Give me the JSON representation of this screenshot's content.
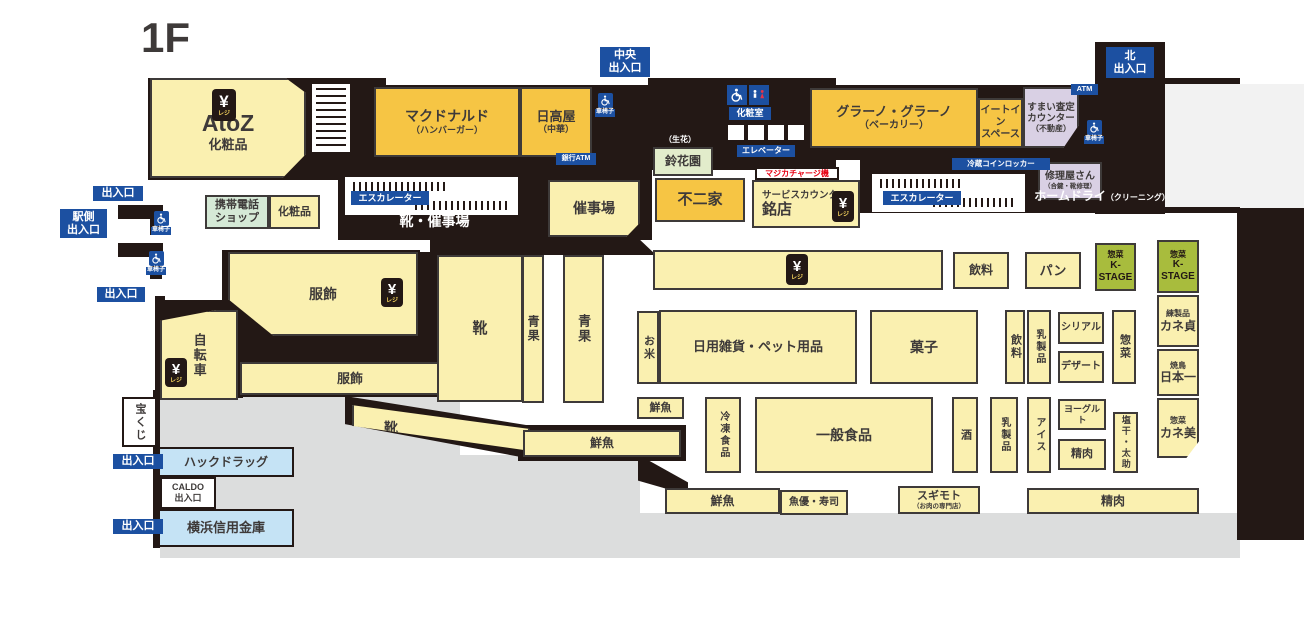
{
  "title": "1F",
  "colors": {
    "wall": "#231815",
    "cream": "#FAF0B0",
    "tenant_yellow": "#F6C544",
    "lavender": "#D9D0E4",
    "light_blue": "#C5E3F5",
    "kstage_green": "#A8BC3D",
    "label_blue": "#1C50A1",
    "exterior_gray": "#DCDDDD",
    "accent_red": "#E60012"
  },
  "icons": {
    "yen_symbol": "¥",
    "regi_label": "レジ",
    "wheelchair_label": "車椅子"
  },
  "areas": [
    {
      "id": "shop-atoz",
      "t": "AtoZ",
      "sub": "化粧品",
      "fs": 23,
      "subfs": 13,
      "cls": "cream",
      "x": 150,
      "y": 78,
      "w": 156,
      "h": 100,
      "padTop": 30,
      "clip": "polygon(0 0, 87% 0, 100% 15%, 100% 76%, 85% 100%, 0 100%)"
    },
    {
      "id": "shop-mcdonalds",
      "t": "マクドナルド",
      "sub": "（ハンバーガー）",
      "fs": 14,
      "subfs": 9,
      "cls": "tenant",
      "x": 374,
      "y": 87,
      "w": 146,
      "h": 70
    },
    {
      "id": "shop-hidakaya",
      "t": "日高屋",
      "sub": "（中華）",
      "fs": 13,
      "subfs": 9,
      "cls": "tenant",
      "x": 520,
      "y": 87,
      "w": 72,
      "h": 70
    },
    {
      "id": "shop-mobile-phone",
      "t": "携帯電話\nショップ",
      "fs": 11,
      "cls": "lgreen",
      "x": 205,
      "y": 195,
      "w": 64,
      "h": 34
    },
    {
      "id": "dept-cosmetics",
      "t": "化粧品",
      "fs": 11,
      "cls": "cream",
      "x": 269,
      "y": 195,
      "w": 51,
      "h": 34
    },
    {
      "id": "event-hall",
      "t": "催事場",
      "fs": 14,
      "cls": "cream",
      "x": 548,
      "y": 180,
      "w": 92,
      "h": 57,
      "clip": "polygon(0 0,100% 0,100% 75%,85% 100%,0 100%)"
    },
    {
      "id": "shop-fujiya",
      "t": "不二家",
      "fs": 15,
      "cls": "tenant",
      "x": 655,
      "y": 178,
      "w": 90,
      "h": 44
    },
    {
      "id": "service-counter",
      "small": "サービスカウンター",
      "smallfs": 9.5,
      "t": "銘店",
      "fs": 15,
      "cls": "cream",
      "x": 752,
      "y": 180,
      "w": 108,
      "h": 48,
      "padLeft": 8
    },
    {
      "id": "shop-grano-grano",
      "t": "グラーノ・グラーノ",
      "sub": "（ベーカリー）",
      "fs": 13,
      "subfs": 10,
      "cls": "tenant",
      "x": 810,
      "y": 88,
      "w": 168,
      "h": 60
    },
    {
      "id": "eat-in-space",
      "t": "イートイン\nスペース",
      "fs": 10,
      "cls": "tenant",
      "x": 978,
      "y": 98,
      "w": 45,
      "h": 50
    },
    {
      "id": "sumai-satei-counter",
      "t": "すまい査定\nカウンター",
      "sub": "（不動産）",
      "fs": 9.5,
      "subfs": 8,
      "cls": "lav",
      "x": 1023,
      "y": 87,
      "w": 56,
      "h": 61,
      "clip": "polygon(0 0,100% 0,100% 62%,72% 100%,0 100%)"
    },
    {
      "id": "shop-shuriyasan",
      "t": "修理屋さん",
      "sub": "（合鍵・靴修理）",
      "fs": 10,
      "subfs": 6.5,
      "cls": "lav",
      "x": 1038,
      "y": 162,
      "w": 64,
      "h": 38
    },
    {
      "id": "shop-suzukaen",
      "t": "鈴花園",
      "fs": 12,
      "cls": "sprout",
      "x": 653,
      "y": 147,
      "w": 60,
      "h": 29
    },
    {
      "id": "dept-fukushoku-upper",
      "t": "服飾",
      "fs": 14,
      "cls": "cream",
      "x": 228,
      "y": 252,
      "w": 190,
      "h": 84,
      "clip": "polygon(0 0,100% 0,100% 100%,24% 100%,0 56%)"
    },
    {
      "id": "dept-fukushoku-lower",
      "t": "服飾",
      "fs": 13,
      "cls": "cream",
      "x": 240,
      "y": 362,
      "w": 220,
      "h": 33
    },
    {
      "id": "dept-bicycle",
      "t": "自転車",
      "fs": 13,
      "v": true,
      "cls": "cream",
      "x": 160,
      "y": 310,
      "w": 78,
      "h": 90,
      "clip": "polygon(0 12%,72% 0,100% 0,100% 100%,0 100%)"
    },
    {
      "id": "dept-shoes-main",
      "t": "靴",
      "fs": 15,
      "cls": "cream",
      "x": 437,
      "y": 255,
      "w": 86,
      "h": 147
    },
    {
      "id": "dept-seika-1",
      "t": "青果",
      "fs": 12,
      "v": true,
      "cls": "cream",
      "x": 522,
      "y": 255,
      "w": 22,
      "h": 148
    },
    {
      "id": "dept-seika-2",
      "t": "青果",
      "fs": 13,
      "v": true,
      "cls": "cream",
      "x": 563,
      "y": 255,
      "w": 41,
      "h": 148
    },
    {
      "id": "dept-shoes-corridor",
      "t": "靴",
      "fs": 14,
      "cls": "cream",
      "x": 352,
      "y": 402,
      "w": 178,
      "h": 52,
      "padLeft": 30,
      "clip": "polygon(0 6%,100% 52%,100% 94%,0 46%)"
    },
    {
      "id": "dept-sengyo-strip1",
      "t": "鮮魚",
      "fs": 12,
      "cls": "cream",
      "x": 523,
      "y": 430,
      "w": 158,
      "h": 27
    },
    {
      "id": "register-row",
      "t": "",
      "fs": 12,
      "cls": "cream",
      "x": 653,
      "y": 250,
      "w": 290,
      "h": 40
    },
    {
      "id": "dept-drinks-1",
      "t": "飲料",
      "fs": 12,
      "cls": "cream",
      "x": 953,
      "y": 252,
      "w": 56,
      "h": 37
    },
    {
      "id": "dept-bread",
      "t": "パン",
      "fs": 13,
      "cls": "cream",
      "x": 1025,
      "y": 252,
      "w": 56,
      "h": 37
    },
    {
      "id": "shop-kstage-small",
      "small": "惣菜",
      "smallfs": 8,
      "t": "K-STAGE",
      "fs": 10,
      "cls": "green",
      "x": 1095,
      "y": 243,
      "w": 41,
      "h": 48
    },
    {
      "id": "shop-kstage-column",
      "small": "惣菜",
      "smallfs": 8,
      "t": "K-STAGE",
      "fs": 10,
      "cls": "green",
      "x": 1157,
      "y": 240,
      "w": 42,
      "h": 53
    },
    {
      "id": "shop-kanesada",
      "small": "練製品",
      "smallfs": 8,
      "t": "カネ貞",
      "fs": 12,
      "cls": "cream",
      "x": 1157,
      "y": 295,
      "w": 42,
      "h": 52
    },
    {
      "id": "shop-nihonichi",
      "small": "焼鳥",
      "smallfs": 8,
      "t": "日本一",
      "fs": 12,
      "cls": "cream",
      "x": 1157,
      "y": 349,
      "w": 42,
      "h": 47
    },
    {
      "id": "shop-kanemi",
      "small": "惣菜",
      "smallfs": 8,
      "t": "カネ美",
      "fs": 12,
      "cls": "cream",
      "x": 1157,
      "y": 398,
      "w": 42,
      "h": 60,
      "clip": "polygon(0 0,100% 0,100% 72%,70% 100%,0 100%)"
    },
    {
      "id": "dept-okome",
      "t": "お米",
      "fs": 11,
      "v": true,
      "cls": "cream",
      "x": 637,
      "y": 311,
      "w": 22,
      "h": 73
    },
    {
      "id": "dept-zakka-pet",
      "t": "日用雑貨・ペット用品",
      "fs": 13,
      "cls": "cream",
      "x": 659,
      "y": 310,
      "w": 198,
      "h": 74
    },
    {
      "id": "dept-kashi",
      "t": "菓子",
      "fs": 14,
      "cls": "cream",
      "x": 870,
      "y": 310,
      "w": 108,
      "h": 74
    },
    {
      "id": "dept-drinks-2",
      "t": "飲料",
      "fs": 11,
      "v": true,
      "cls": "cream",
      "x": 1005,
      "y": 310,
      "w": 20,
      "h": 74
    },
    {
      "id": "dept-dairy-1",
      "t": "乳製品",
      "fs": 10,
      "v": true,
      "cls": "cream",
      "x": 1027,
      "y": 310,
      "w": 24,
      "h": 74
    },
    {
      "id": "dept-cereal",
      "t": "シリアル",
      "fs": 10,
      "cls": "cream",
      "x": 1058,
      "y": 312,
      "w": 46,
      "h": 32
    },
    {
      "id": "dept-dessert",
      "t": "デザート",
      "fs": 10,
      "cls": "cream",
      "x": 1058,
      "y": 351,
      "w": 46,
      "h": 32
    },
    {
      "id": "dept-sozai-v",
      "t": "惣菜",
      "fs": 11,
      "v": true,
      "cls": "cream",
      "x": 1112,
      "y": 310,
      "w": 24,
      "h": 74
    },
    {
      "id": "dept-sengyo-small",
      "t": "鮮魚",
      "fs": 11,
      "cls": "cream",
      "x": 637,
      "y": 397,
      "w": 47,
      "h": 22
    },
    {
      "id": "dept-frozen",
      "t": "冷凍食品",
      "fs": 10,
      "v": true,
      "cls": "cream",
      "x": 705,
      "y": 397,
      "w": 36,
      "h": 76
    },
    {
      "id": "dept-ippan-foods",
      "t": "一般食品",
      "fs": 14,
      "cls": "cream",
      "x": 755,
      "y": 397,
      "w": 178,
      "h": 76
    },
    {
      "id": "dept-sake",
      "t": "酒",
      "fs": 11,
      "v": true,
      "cls": "cream",
      "x": 952,
      "y": 397,
      "w": 26,
      "h": 76
    },
    {
      "id": "dept-dairy-2",
      "t": "乳製品",
      "fs": 10,
      "v": true,
      "cls": "cream",
      "x": 990,
      "y": 397,
      "w": 28,
      "h": 76
    },
    {
      "id": "dept-ice",
      "t": "アイス",
      "fs": 10,
      "v": true,
      "cls": "cream",
      "x": 1027,
      "y": 397,
      "w": 24,
      "h": 76
    },
    {
      "id": "dept-yogurt",
      "t": "ヨーグルト",
      "fs": 9,
      "cls": "cream",
      "x": 1058,
      "y": 399,
      "w": 48,
      "h": 31
    },
    {
      "id": "dept-seiniku-small",
      "t": "精肉",
      "fs": 11,
      "cls": "cream",
      "x": 1058,
      "y": 439,
      "w": 48,
      "h": 31
    },
    {
      "id": "dept-shioboshi",
      "t": "塩干・太助",
      "fs": 9,
      "v": true,
      "cls": "cream",
      "x": 1113,
      "y": 412,
      "w": 25,
      "h": 61
    },
    {
      "id": "dept-sengyo-strip2",
      "t": "鮮魚",
      "fs": 12,
      "cls": "cream",
      "x": 665,
      "y": 488,
      "w": 115,
      "h": 26
    },
    {
      "id": "shop-uoyu-sushi",
      "t": "魚優・寿司",
      "fs": 10,
      "cls": "cream",
      "x": 780,
      "y": 490,
      "w": 68,
      "h": 25
    },
    {
      "id": "shop-sugimoto",
      "t": "スギモト",
      "sub": "（お肉の専門店）",
      "fs": 11,
      "subfs": 6.5,
      "cls": "cream",
      "x": 898,
      "y": 486,
      "w": 82,
      "h": 28
    },
    {
      "id": "dept-seiniku-strip",
      "t": "精肉",
      "fs": 12,
      "cls": "cream",
      "x": 1027,
      "y": 488,
      "w": 172,
      "h": 26
    },
    {
      "id": "takarakuji",
      "t": "宝くじ",
      "fs": 11,
      "v": true,
      "cls": "whitebox",
      "x": 122,
      "y": 397,
      "w": 35,
      "h": 50
    },
    {
      "id": "shop-hac-drug",
      "t": "ハックドラッグ",
      "fs": 12,
      "cls": "lblue",
      "x": 158,
      "y": 447,
      "w": 136,
      "h": 30
    },
    {
      "id": "caldo-exit",
      "t": "CALDO\n出入口",
      "fs": 9,
      "cls": "whitebox",
      "x": 160,
      "y": 477,
      "w": 56,
      "h": 32
    },
    {
      "id": "shop-yokohama-shinkin",
      "t": "横浜信用金庫",
      "fs": 13,
      "cls": "lblue",
      "x": 158,
      "y": 509,
      "w": 136,
      "h": 38
    }
  ],
  "labels": [
    {
      "id": "exit-west-1",
      "t": "出入口",
      "fs": 11,
      "cls": "blue",
      "x": 93,
      "y": 186,
      "w": 50,
      "h": 15
    },
    {
      "id": "exit-station-side",
      "t": "駅側\n出入口",
      "fs": 11,
      "cls": "blue",
      "x": 60,
      "y": 209,
      "w": 47,
      "h": 29
    },
    {
      "id": "exit-west-2",
      "t": "出入口",
      "fs": 11,
      "cls": "blue",
      "x": 97,
      "y": 287,
      "w": 48,
      "h": 15
    },
    {
      "id": "exit-west-3",
      "t": "出入口",
      "fs": 11,
      "cls": "blue",
      "x": 113,
      "y": 454,
      "w": 50,
      "h": 15
    },
    {
      "id": "exit-west-4",
      "t": "出入口",
      "fs": 11,
      "cls": "blue",
      "x": 113,
      "y": 519,
      "w": 50,
      "h": 15
    },
    {
      "id": "exit-central",
      "t": "中央\n出入口",
      "fs": 11,
      "cls": "blue",
      "x": 600,
      "y": 47,
      "w": 50,
      "h": 30
    },
    {
      "id": "exit-north",
      "t": "北\n出入口",
      "fs": 11,
      "cls": "blue",
      "x": 1106,
      "y": 47,
      "w": 48,
      "h": 31
    },
    {
      "id": "restroom-label",
      "t": "化粧室",
      "fs": 9,
      "cls": "blue",
      "x": 729,
      "y": 107,
      "w": 42,
      "h": 13
    },
    {
      "id": "elevator-label",
      "t": "エレベーター",
      "fs": 8,
      "cls": "blue",
      "x": 737,
      "y": 145,
      "w": 58,
      "h": 12
    },
    {
      "id": "escalator-label-left",
      "t": "エスカレーター",
      "fs": 9,
      "cls": "blue",
      "x": 351,
      "y": 191,
      "w": 78,
      "h": 14
    },
    {
      "id": "escalator-label-right",
      "t": "エスカレーター",
      "fs": 9,
      "cls": "blue",
      "x": 883,
      "y": 191,
      "w": 78,
      "h": 14
    },
    {
      "id": "bank-atm-label",
      "t": "銀行ATM",
      "fs": 7,
      "cls": "blue",
      "x": 556,
      "y": 153,
      "w": 40,
      "h": 12
    },
    {
      "id": "atm-label",
      "t": "ATM",
      "fs": 7.5,
      "cls": "blue",
      "x": 1071,
      "y": 84,
      "w": 27,
      "h": 11
    },
    {
      "id": "coin-locker-label",
      "t": "冷蔵コインロッカー",
      "fs": 7.5,
      "cls": "blue",
      "x": 952,
      "y": 158,
      "w": 98,
      "h": 12
    },
    {
      "id": "shoes-event-hall-label",
      "t": "靴・催事場",
      "fs": 14,
      "cls": "blacktext",
      "x": 372,
      "y": 212,
      "w": 125,
      "h": 18
    },
    {
      "id": "seika-note",
      "t": "（生花）",
      "fs": 8,
      "cls": "blacktext",
      "x": 658,
      "y": 134,
      "w": 44,
      "h": 11
    },
    {
      "id": "home-dry-label",
      "t": "ホームドライ",
      "sub": "（クリーニング）",
      "fs": 12,
      "subfs": 8,
      "cls": "blacktext",
      "row": true,
      "x": 1036,
      "y": 189,
      "w": 132,
      "h": 17
    },
    {
      "id": "majica-charge-label",
      "t": "マジカチャージ機",
      "fs": 8,
      "cls": "redlabel",
      "x": 755,
      "y": 167,
      "w": 84,
      "h": 13
    }
  ]
}
